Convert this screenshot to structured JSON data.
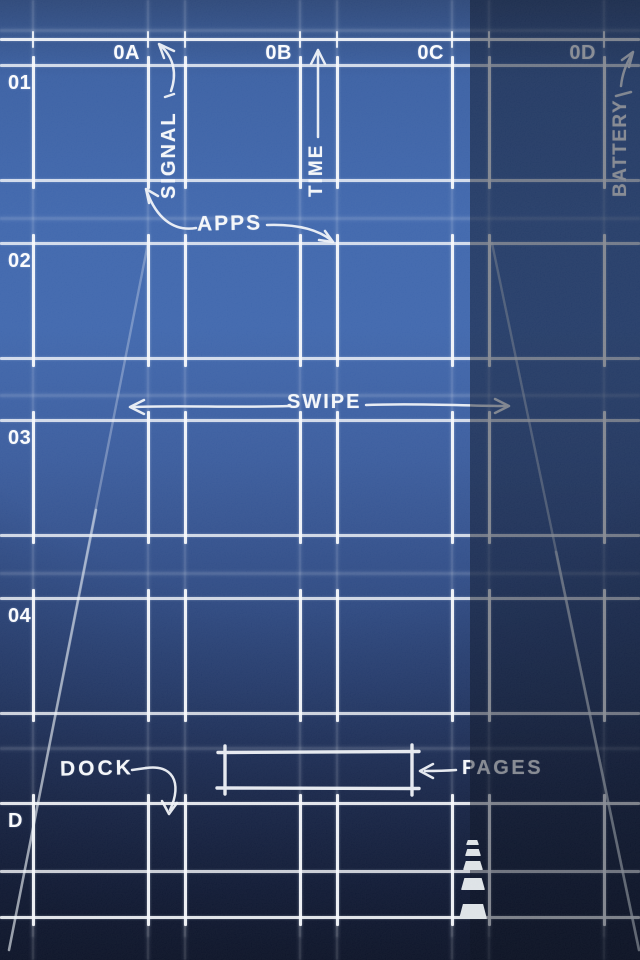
{
  "wallpaper_title": "home screen blueprint",
  "grid": {
    "column_labels": [
      "0A",
      "0B",
      "0C",
      "0D"
    ],
    "row_labels": [
      "01",
      "02",
      "03",
      "04"
    ],
    "dock_row_label": "D"
  },
  "status_annotations": {
    "signal_label": "SIGNAL",
    "time_label": "TIME",
    "battery_label": "BATTERY"
  },
  "annotations": {
    "apps_label": "APPS",
    "swipe_label": "SWIPE",
    "dock_label": "DOCK",
    "pages_label": "PAGES"
  },
  "colors": {
    "background_blue": "#3c64ab",
    "background_bottom": "#0b142e",
    "line_white": "#f7f9fc",
    "shade_band": "rgba(7,12,28,0.48)",
    "road_dash": "#dde2e6"
  },
  "icons": {
    "signal_arrow": "curved-arrow-up-left",
    "time_arrow": "arrow-up",
    "battery_arrow": "arrow-up-right",
    "apps_arrows": "arrows-to-app-slots",
    "swipe_arrows": "double-horizontal-arrows",
    "dock_arrow": "curved-arrow-down",
    "pages_arrow": "arrow-left"
  }
}
